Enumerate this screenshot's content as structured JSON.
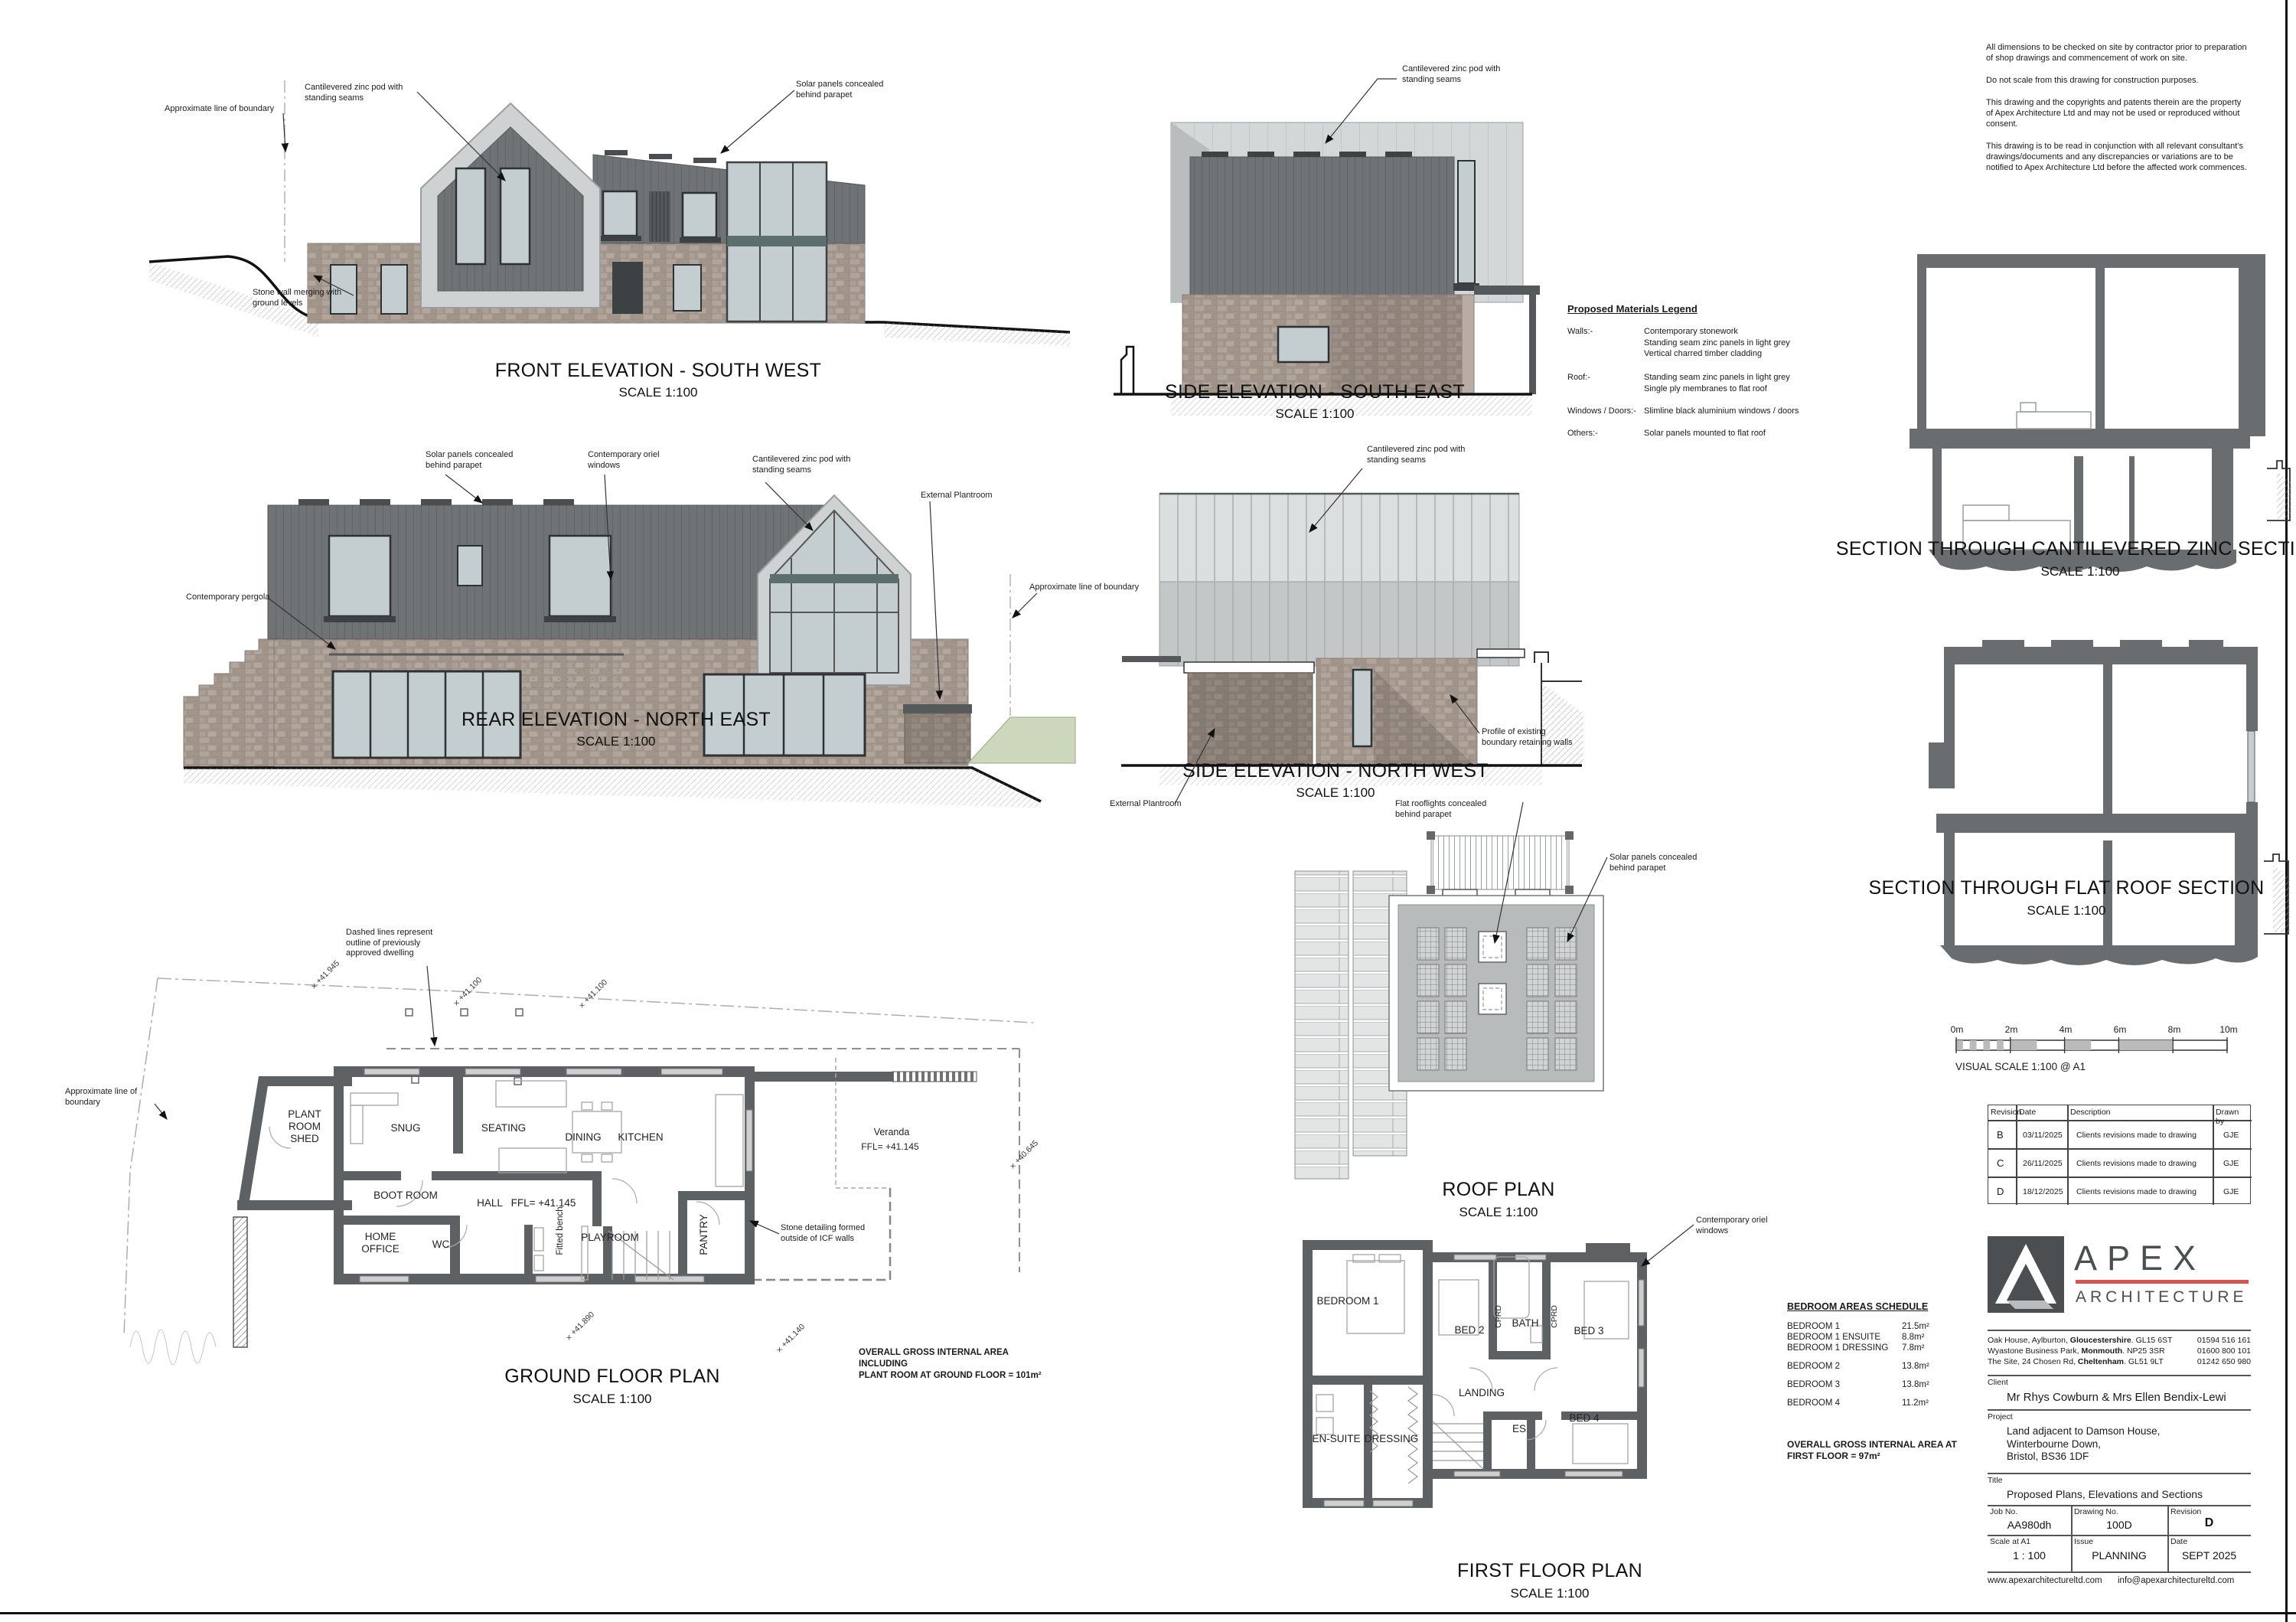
{
  "notes": [
    "All dimensions to be checked on site by contractor prior to preparation of shop drawings and commencement of work on site.",
    "Do not scale from this drawing for construction purposes.",
    "This drawing and the copyrights and patents therein are the property of Apex Architecture Ltd and may not be used or reproduced without consent.",
    "This drawing is to be read in conjunction with all relevant consultant's drawings/documents and any discrepancies or variations are to be notified to Apex Architecture Ltd before the affected work commences."
  ],
  "drawings": {
    "front": {
      "title": "FRONT ELEVATION - SOUTH WEST",
      "scale": "SCALE 1:100"
    },
    "rear": {
      "title": "REAR ELEVATION - NORTH EAST",
      "scale": "SCALE 1:100"
    },
    "side_se": {
      "title": "SIDE ELEVATION - SOUTH EAST",
      "scale": "SCALE 1:100"
    },
    "side_nw": {
      "title": "SIDE ELEVATION - NORTH WEST",
      "scale": "SCALE 1:100"
    },
    "section_zinc": {
      "title": "SECTION THROUGH CANTILEVERED ZINC SECTION",
      "scale": "SCALE 1:100"
    },
    "section_flat": {
      "title": "SECTION THROUGH FLAT ROOF SECTION",
      "scale": "SCALE 1:100"
    },
    "ground": {
      "title": "GROUND FLOOR PLAN",
      "scale": "SCALE 1:100"
    },
    "roof": {
      "title": "ROOF PLAN",
      "scale": "SCALE 1:100"
    },
    "first": {
      "title": "FIRST FLOOR PLAN",
      "scale": "SCALE 1:100"
    }
  },
  "annotations": {
    "pod": "Cantilevered zinc pod with\nstanding seams",
    "solar_parapet": "Solar panels concealed\nbehind parapet",
    "boundary": "Approximate line of boundary",
    "stone_wall": "Stone wall merging with\nground levels",
    "oriel": "Contemporary oriel\nwindows",
    "plantroom": "External Plantroom",
    "pergola": "Contemporary pergola",
    "retaining": "Profile of existing\nboundary retaining walls",
    "rooflights": "Flat rooflights concealed\nbehind parapet",
    "dashed_outline": "Dashed lines represent\noutline of previously\napproved dwelling",
    "icf": "Stone detailing formed\noutside of ICF walls"
  },
  "ground_rooms": {
    "plant": "PLANT\nROOM\nSHED",
    "snug": "SNUG",
    "seating": "SEATING",
    "dining": "DINING",
    "kitchen": "KITCHEN",
    "boot": "BOOT ROOM",
    "hall": "HALL",
    "ffl": "FFL= +41.145",
    "home_office": "HOME\nOFFICE",
    "wc": "WC",
    "playroom": "PLAYROOM",
    "pantry": "PANTRY",
    "bench": "Fitted bench",
    "veranda": "Veranda",
    "area_note": "OVERALL GROSS INTERNAL AREA INCLUDING\nPLANT ROOM AT GROUND FLOOR = 101m²"
  },
  "first_rooms": {
    "bed1": "BEDROOM 1",
    "bed2": "BED 2",
    "bed3": "BED 3",
    "bed4": "BED 4",
    "bath": "BATH",
    "cprd": "CPRD",
    "landing": "LANDING",
    "ensuite": "EN-SUITE",
    "dressing": "DRESSING",
    "es": "ES"
  },
  "levels": {
    "l1": "+41.945",
    "l2": "+41.100",
    "l3": "+41.100",
    "l4": "+40.645",
    "l5": "+41.890",
    "l6": "+41.140"
  },
  "materials": {
    "title": "Proposed Materials Legend",
    "rows": [
      {
        "key": "Walls:-",
        "value": "Contemporary stonework\nStanding seam zinc panels in light grey\nVertical charred timber cladding"
      },
      {
        "key": "Roof:-",
        "value": "Standing seam zinc panels in light grey\nSingle ply membranes to flat roof"
      },
      {
        "key": "Windows / Doors:-",
        "value": "Slimline black aluminium windows / doors"
      },
      {
        "key": "Others:-",
        "value": "Solar panels mounted to flat roof"
      }
    ]
  },
  "schedule": {
    "title": "BEDROOM AREAS SCHEDULE",
    "rows": [
      {
        "label": "BEDROOM 1",
        "area": "21.5m²"
      },
      {
        "label": "BEDROOM 1 ENSUITE",
        "area": "8.8m²"
      },
      {
        "label": "BEDROOM 1 DRESSING",
        "area": "7.8m²"
      },
      {
        "label": "BEDROOM 2",
        "area": "13.8m²"
      },
      {
        "label": "BEDROOM 3",
        "area": "13.8m²"
      },
      {
        "label": "BEDROOM 4",
        "area": "11.2m²"
      }
    ],
    "total": "OVERALL GROSS INTERNAL AREA AT\nFIRST FLOOR = 97m²"
  },
  "visual_scale": {
    "ticks": [
      "0m",
      "2m",
      "4m",
      "6m",
      "8m",
      "10m"
    ],
    "caption": "VISUAL SCALE 1:100  @ A1"
  },
  "revisions": {
    "headers": [
      "Revision",
      "Date",
      "Description",
      "Drawn by"
    ],
    "rows": [
      {
        "rev": "B",
        "date": "03/11/2025",
        "desc": "Clients revisions made to drawing",
        "by": "GJE"
      },
      {
        "rev": "C",
        "date": "26/11/2025",
        "desc": "Clients revisions made to drawing",
        "by": "GJE"
      },
      {
        "rev": "D",
        "date": "18/12/2025",
        "desc": "Clients revisions made to drawing",
        "by": "GJE"
      }
    ]
  },
  "title_block": {
    "logo_top": "APEX",
    "logo_bottom": "ARCHITECTURE",
    "addresses": [
      {
        "pre": "Oak House, Aylburton, ",
        "bold": "Gloucestershire",
        "post": ". GL15 6ST"
      },
      {
        "pre": "Wyastone Business Park, ",
        "bold": "Monmouth",
        "post": ". NP25 3SR"
      },
      {
        "pre": "The Site, 24 Chosen Rd, ",
        "bold": "Cheltenham",
        "post": ". GL51 9LT"
      }
    ],
    "phones": [
      "01594 516 161",
      "01600 800 101",
      "01242 650 980"
    ],
    "client_label": "Client",
    "client": "Mr Rhys Cowburn & Mrs Ellen Bendix-Lewi",
    "project_label": "Project",
    "project": "Land adjacent to Damson House,\nWinterbourne Down,\nBristol, BS36 1DF",
    "title_label": "Title",
    "title": "Proposed Plans, Elevations and Sections",
    "job_label": "Job No.",
    "job": "AA980dh",
    "dwg_label": "Drawing No.",
    "dwg": "100D",
    "rev_label": "Revision",
    "rev": "D",
    "scale_label": "Scale at A1",
    "scale": "1 : 100",
    "issue_label": "Issue",
    "issue": "PLANNING",
    "date_label": "Date",
    "date": "SEPT 2025",
    "web": "www.apexarchitectureltd.com",
    "email": "info@apexarchitectureltd.com"
  },
  "colors": {
    "accent_red": "#d9534f",
    "wall_grey": "#5d6163",
    "zinc_dark": "#6f7375",
    "zinc_light": "#d4d7d8",
    "stone": "#a89c94"
  }
}
